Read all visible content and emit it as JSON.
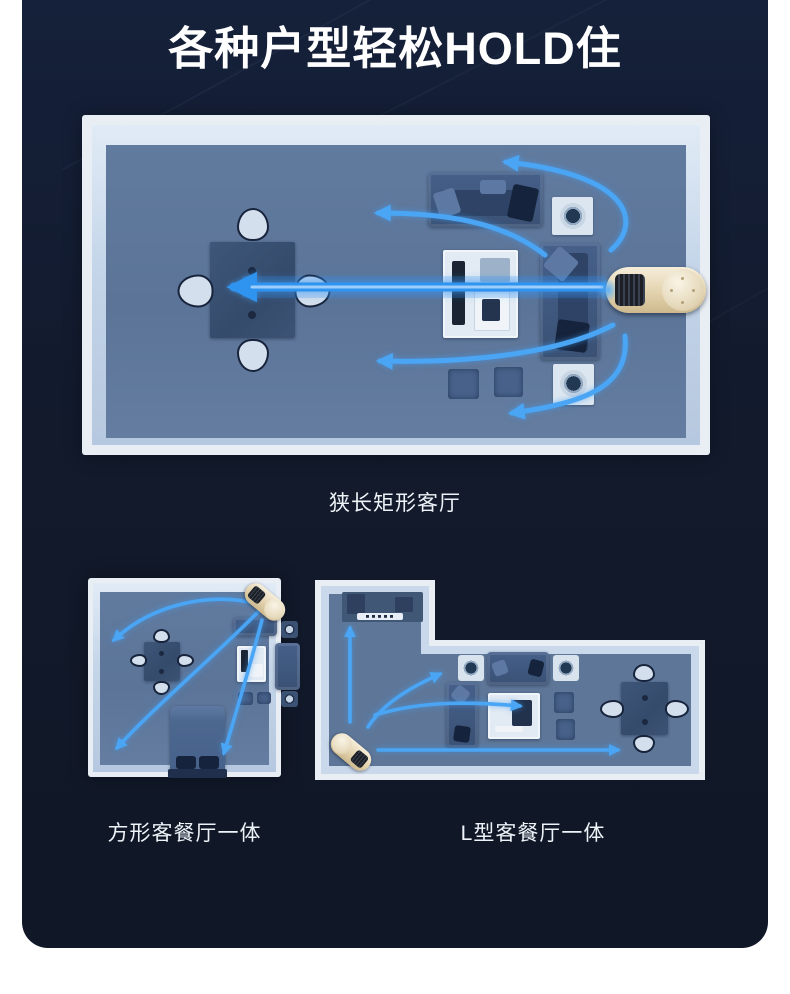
{
  "title": "各种户型轻松HOLD住",
  "diagrams": [
    {
      "name": "narrow-rectangular-living-room",
      "caption": "狭长矩形客厅"
    },
    {
      "name": "square-living-dining-room",
      "caption": "方形客餐厅一体"
    },
    {
      "name": "l-shaped-living-dining-room",
      "caption": "L型客餐厅一体"
    }
  ],
  "colors": {
    "page_bg": "#ffffff",
    "panel_bg": "#121a2c",
    "wall": "#e9eef4",
    "floor": "#5e7799",
    "airflow_accent": "#3f9ef3",
    "device_gold": "#e6d7b4"
  },
  "icons": {
    "device": "air-circulator-fan",
    "arrows": "airflow-direction-arrow"
  }
}
